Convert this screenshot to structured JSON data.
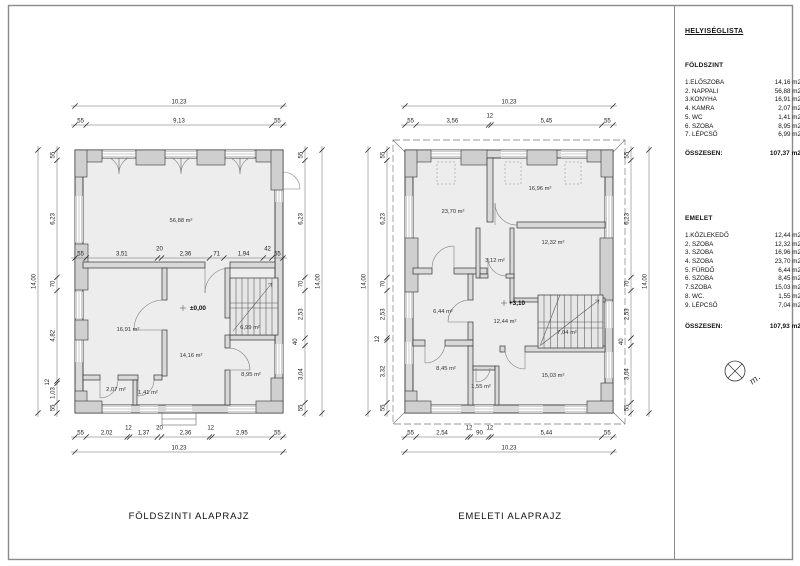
{
  "sheet": {
    "frame_color": "#8a8a8a",
    "wall_fill": "#d9d9d9",
    "floor_fill": "#ededed"
  },
  "panel": {
    "title": "HELYISÉGLISTA",
    "north_label": "m.",
    "sections": [
      {
        "heading": "FÖLDSZINT",
        "rows": [
          {
            "name": "1.ELŐSZOBA",
            "area": "14,16 m2"
          },
          {
            "name": "2. NAPPALI",
            "area": "56,88 m2"
          },
          {
            "name": "3.KONYHA",
            "area": "16,91 m2"
          },
          {
            "name": "4. KAMRA",
            "area": "2,07 m2"
          },
          {
            "name": "5. WC",
            "area": "1,41 m2"
          },
          {
            "name": "6. SZOBA",
            "area": "8,95 m2"
          },
          {
            "name": "7. LÉPCSŐ",
            "area": "6,99 m2"
          }
        ],
        "total_label": "ÖSSZESEN:",
        "total_value": "107,37 m2"
      },
      {
        "heading": "EMELET",
        "rows": [
          {
            "name": "1.KÖZLEKEDŐ",
            "area": "12,44 m2"
          },
          {
            "name": "2. SZOBA",
            "area": "12,32 m2"
          },
          {
            "name": "3. SZOBA",
            "area": "16,96 m2"
          },
          {
            "name": "4. SZOBA",
            "area": "23,70 m2"
          },
          {
            "name": "5. FÜRDŐ",
            "area": "6,44 m2"
          },
          {
            "name": "6. SZOBA",
            "area": "8,45 m2"
          },
          {
            "name": "7.SZOBA",
            "area": "15,03 m2"
          },
          {
            "name": "8. WC.",
            "area": "1,55 m2"
          },
          {
            "name": "9. LÉPCSŐ",
            "area": "7,04 m2"
          }
        ],
        "total_label": "ÖSSZESEN:",
        "total_value": "107,93 m2"
      }
    ]
  },
  "plans": [
    {
      "title": "FÖLDSZINTI ALAPRAJZ",
      "level_marker": "±0,00",
      "rooms": {
        "nappali": "56,88 m²",
        "konyha": "16,91 m²",
        "eloszoba": "14,16 m²",
        "lepcso": "6,99 m²",
        "szoba": "8,95 m²",
        "kamra": "2,07 m²",
        "wc": "1,41 m²"
      },
      "dims": {
        "top_total": [
          "10,23"
        ],
        "top": [
          "55",
          "9,13",
          "55"
        ],
        "mid": [
          "55",
          "3,51",
          "20",
          "2,36",
          "71",
          "1,94",
          "42",
          "55"
        ],
        "bottom": [
          "55",
          "2,02",
          "12",
          "1,37",
          "20",
          "2,36",
          "12",
          "2,95",
          "55"
        ],
        "bottom_total": [
          "10,23"
        ],
        "left": [
          "55",
          "6,23",
          "70",
          "4,82",
          "12",
          "1,03",
          "55"
        ],
        "left_total": [
          "14,00"
        ],
        "right": [
          "55",
          "6,23",
          "70",
          "2,53",
          "40",
          "3,04",
          "55"
        ],
        "right_total": [
          "14,00"
        ]
      }
    },
    {
      "title": "EMELETI ALAPRAJZ",
      "level_marker": "+3,10",
      "rooms": {
        "szoba4": "23,70 m²",
        "szoba3": "16,96 m²",
        "szoba2": "12,32 m²",
        "kisszoba": "3,12 m²",
        "furdo": "6,44 m²",
        "kozlekedo": "12,44 m²",
        "lepcso": "7,04 m²",
        "szoba6": "8,45 m²",
        "wc": "1,55 m²",
        "szoba7": "15,03 m²"
      },
      "dims": {
        "top_total": [
          "10,23"
        ],
        "top": [
          "55",
          "3,56",
          "12",
          "5,45",
          "55"
        ],
        "bottom": [
          "55",
          "2,54",
          "12",
          "90",
          "12",
          "5,44",
          "55"
        ],
        "bottom_total": [
          "10,23"
        ],
        "left": [
          "55",
          "6,23",
          "70",
          "2,53",
          "12",
          "3,32",
          "55"
        ],
        "left_total": [
          "14,00"
        ],
        "right": [
          "55",
          "6,23",
          "70",
          "2,53",
          "40",
          "3,04",
          "55"
        ],
        "right_total": [
          "14,00"
        ]
      }
    }
  ]
}
